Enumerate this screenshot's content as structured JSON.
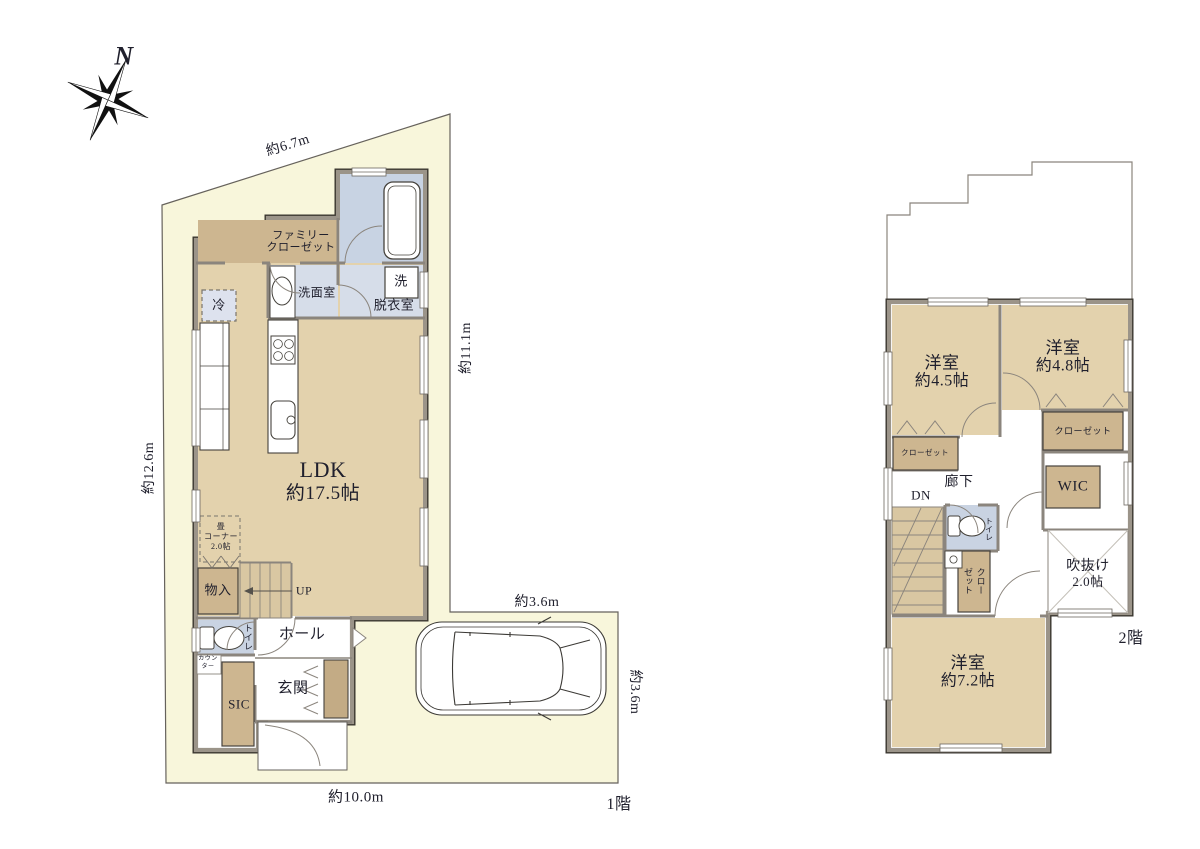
{
  "compass": {
    "label": "N"
  },
  "floor1": {
    "label": "1階",
    "dimensions": {
      "top_slant": "約6.7m",
      "left": "約12.6m",
      "right": "約11.1m",
      "parking_top": "約3.6m",
      "parking_right": "約3.6m",
      "bottom": "約10.0m"
    },
    "rooms": {
      "ldk": {
        "name": "LDK",
        "area": "約17.5帖"
      },
      "family_closet": {
        "line1": "ファミリー",
        "line2": "クローゼット"
      },
      "washroom": {
        "name": "洗面室"
      },
      "washer": {
        "name": "洗"
      },
      "dressing_room": {
        "name": "脱衣室"
      },
      "fridge": {
        "name": "冷"
      },
      "tatami_corner": {
        "line1": "畳",
        "line2": "コーナー",
        "line3": "2.0帖"
      },
      "storage": {
        "name": "物入"
      },
      "stairs_up": {
        "name": "UP"
      },
      "toilet": {
        "name": "トイレ"
      },
      "counter": {
        "line1": "カウン",
        "line2": "ター"
      },
      "sic": {
        "name": "SIC"
      },
      "hall": {
        "name": "ホール"
      },
      "entrance": {
        "name": "玄関"
      }
    }
  },
  "floor2": {
    "label": "2階",
    "rooms": {
      "room_45": {
        "name": "洋室",
        "area": "約4.5帖"
      },
      "room_48": {
        "name": "洋室",
        "area": "約4.8帖"
      },
      "room_72": {
        "name": "洋室",
        "area": "約7.2帖"
      },
      "closet_45": {
        "name": "クローゼット"
      },
      "closet_48": {
        "name": "クローゼット"
      },
      "closet_hall": {
        "line1": "クロー",
        "line2": "ゼット"
      },
      "wic": {
        "name": "WIC"
      },
      "hallway": {
        "name": "廊下"
      },
      "stairs_down": {
        "name": "DN"
      },
      "toilet": {
        "name": "トイレ"
      },
      "void": {
        "line1": "吹抜け",
        "line2": "2.0帖"
      }
    }
  },
  "palette": {
    "site_fill": "#f8f6db",
    "floor_tan": "#e3d2ad",
    "closet_brown": "#cdb690",
    "wet_blue": "#ccd6e5",
    "wet_blue_light": "#d6dde9",
    "stairs_tan": "#d9c7a2",
    "wall_gray": "#9b9489",
    "wall_edge": "#3a362f",
    "boundary_line": "#66625c"
  }
}
